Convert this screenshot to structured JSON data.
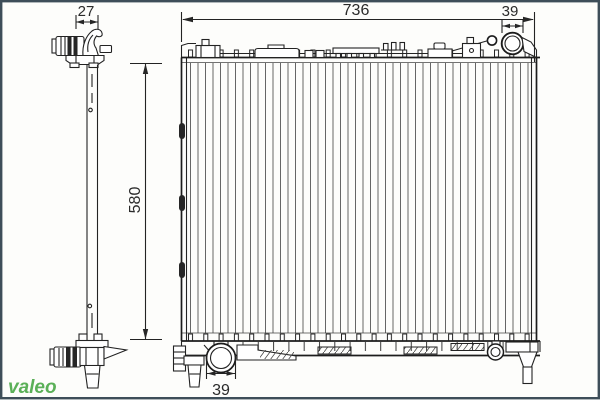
{
  "drawing": {
    "dimensions": {
      "side_depth": "27",
      "overall_width": "736",
      "inlet_pipe_diameter": "39",
      "core_height": "580",
      "outlet_pipe_diameter": "39"
    },
    "logo": {
      "text": "valeo",
      "color": "#3FA33C"
    },
    "colors": {
      "line": "#232323",
      "fin_line": "#666666",
      "frame_border": "#3E4E59",
      "background": "#FDFDFB"
    }
  }
}
